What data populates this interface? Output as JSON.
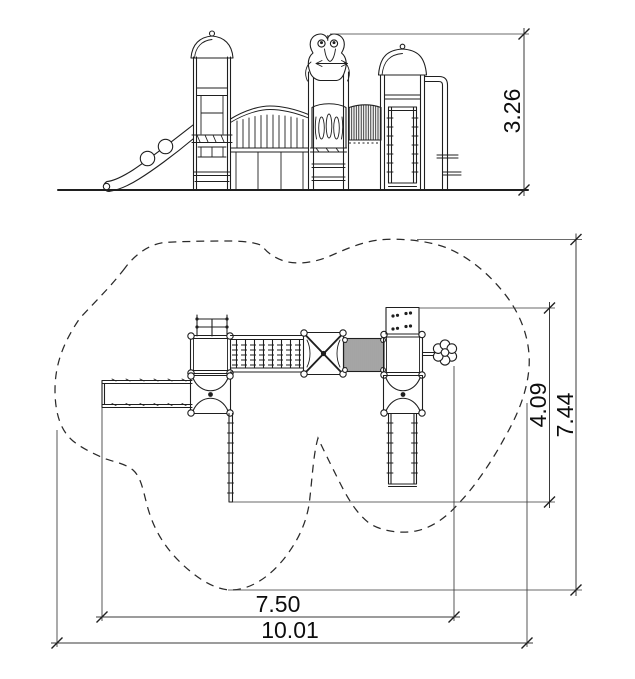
{
  "drawing": {
    "type": "playground-structure-technical-drawing",
    "views": {
      "elevation": {
        "height_label": "3.26"
      },
      "plan": {
        "inner_depth_label": "4.09",
        "total_depth_label": "7.44",
        "inner_width_label": "7.50",
        "total_width_label": "10.01"
      }
    },
    "colors": {
      "background": "#ffffff",
      "line": "#1f1f1f",
      "dimension": "#3a3a3a"
    }
  }
}
